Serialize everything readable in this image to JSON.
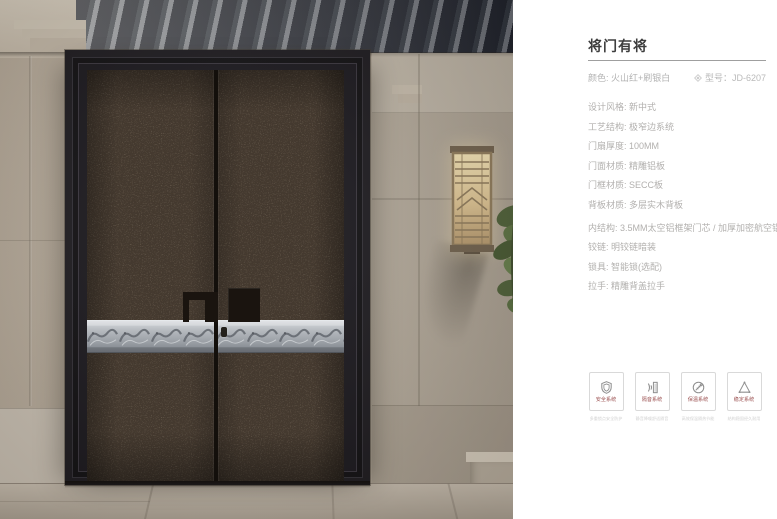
{
  "panel": {
    "title": "将门有将",
    "color_label": "颜色: 火山红+刷银白",
    "model_label": "型号：JD-6207",
    "specs": [
      "设计风格: 新中式",
      "工艺结构: 极窄边系统",
      "门扇厚度: 100MM",
      "门面材质: 精雕铝板",
      "门框材质: SECC板",
      "背板材质: 多层实木背板",
      "内结构: 3.5MM太空铝框架门芯 / 加厚加密航空铝箔",
      "铰链: 明铰链暗装",
      "锁具: 智能锁(选配)",
      "拉手: 精雕背盖拉手"
    ],
    "features": [
      {
        "label": "安全系统",
        "icon": "shield-icon",
        "caption": "多重锁点安全防护"
      },
      {
        "label": "隔音系统",
        "icon": "soundproof-icon",
        "caption": "静音降噪舒适隔音"
      },
      {
        "label": "保温系统",
        "icon": "insulation-icon",
        "caption": "高效保温隔热节能"
      },
      {
        "label": "稳定系统",
        "icon": "stability-icon",
        "caption": "结构稳固经久耐用"
      }
    ]
  },
  "colors": {
    "panel_bg": "#ffffff",
    "title_text": "#3e3e3e",
    "spec_text": "#b2b0ae",
    "feature_label": "#9b5050",
    "door_leaf": "#473a2e",
    "door_frame": "#17151a",
    "silver_band": "#b6babf",
    "stone_wall": "#b2a899",
    "ceiling_beam": "#1f2533"
  }
}
